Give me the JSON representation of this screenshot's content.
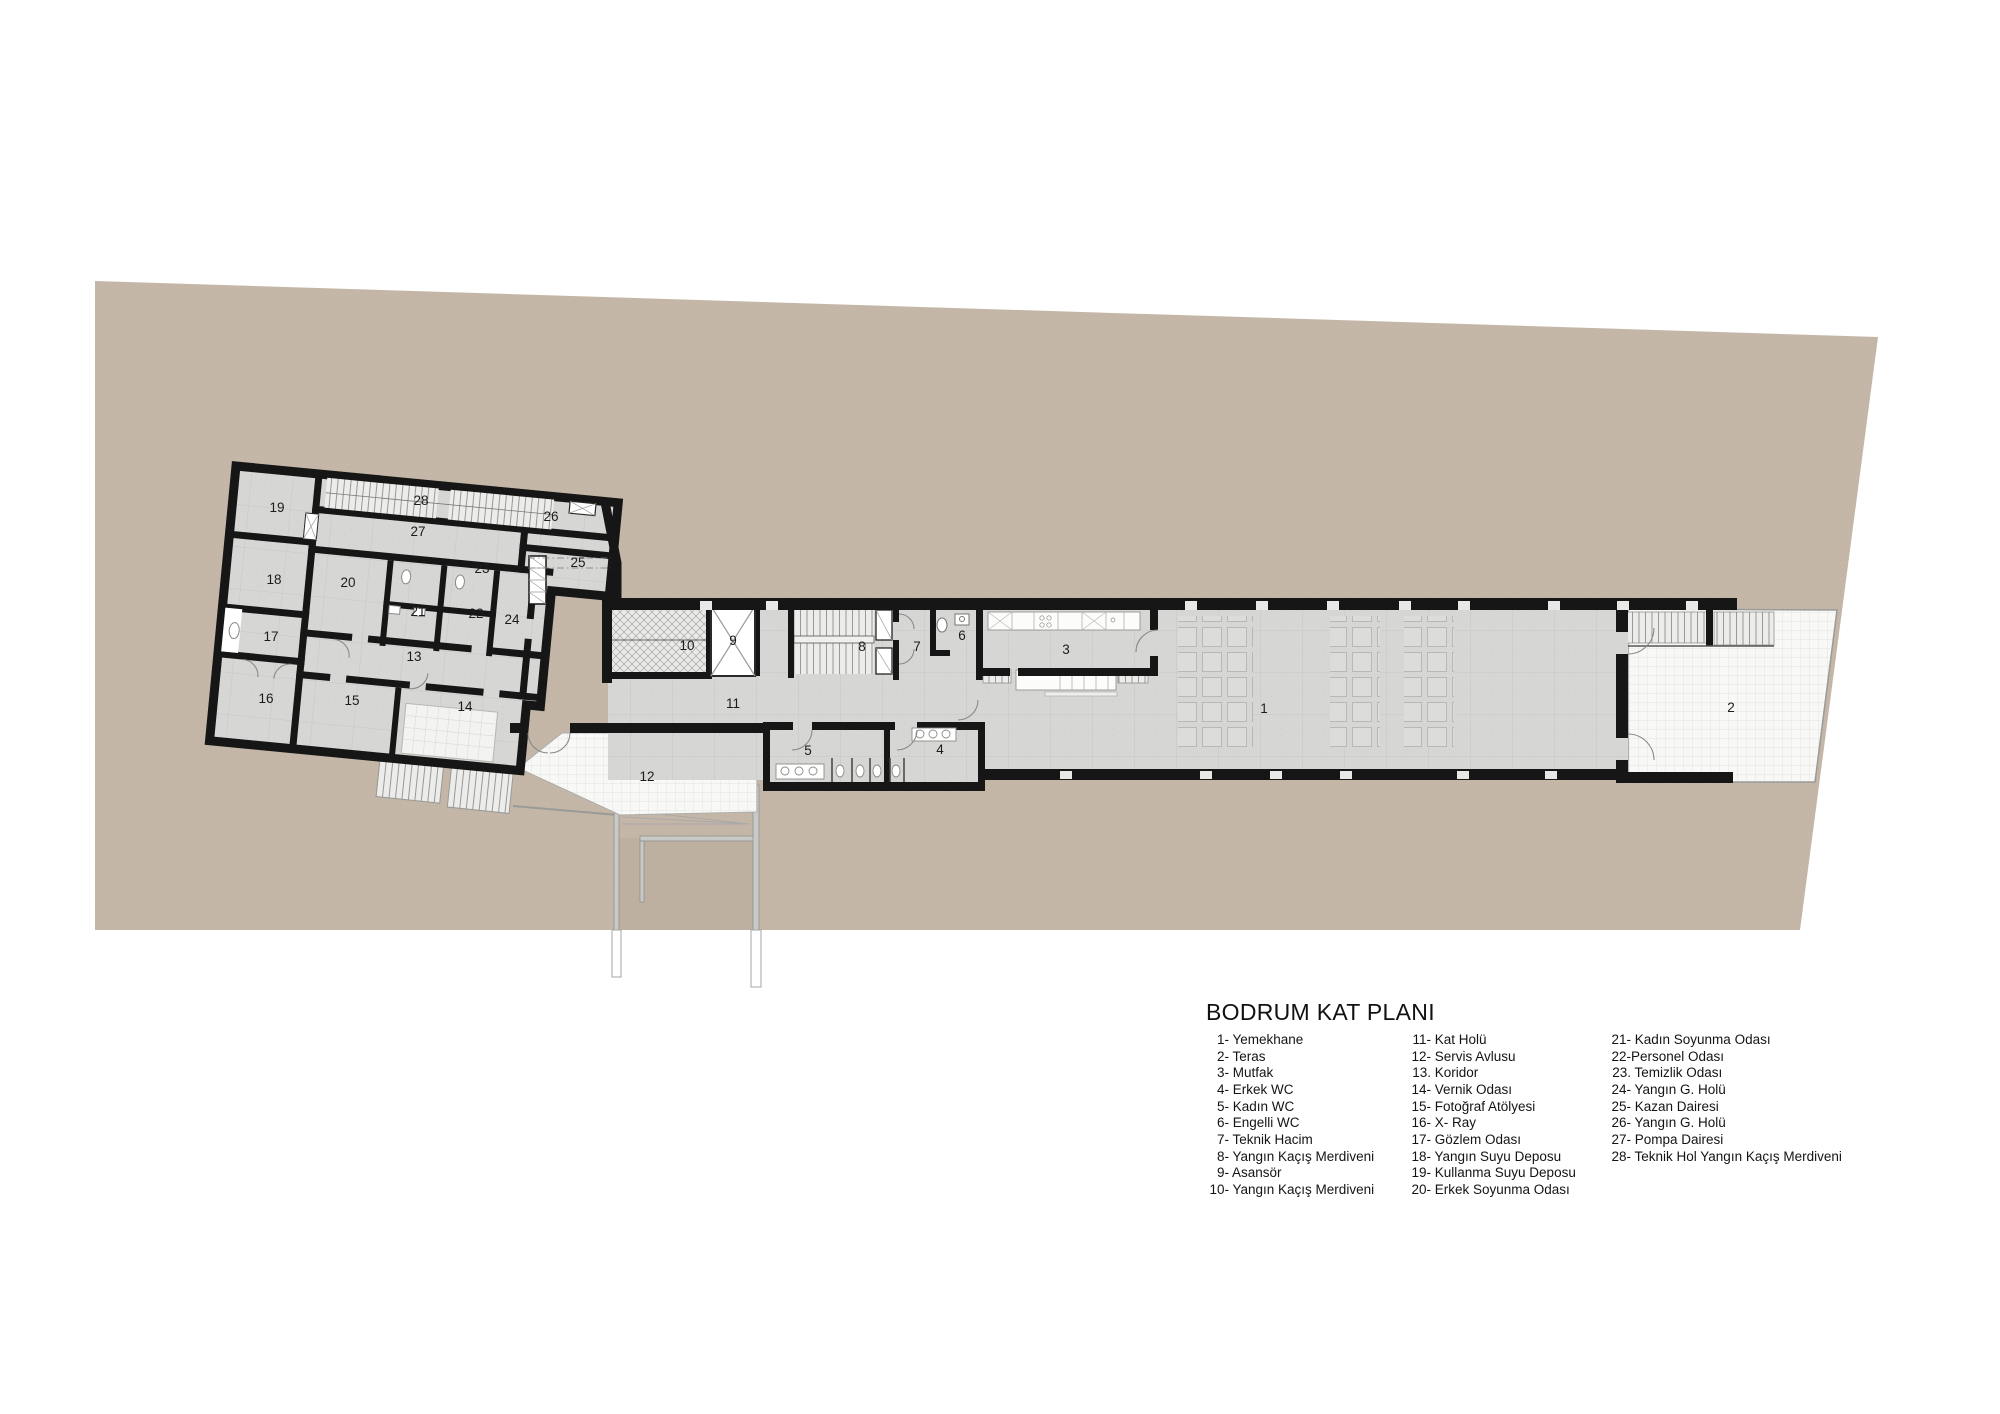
{
  "plan": {
    "title": "BODRUM KAT PLANI",
    "room_numbers": [
      "1",
      "2",
      "3",
      "4",
      "5",
      "6",
      "7",
      "8",
      "9",
      "10",
      "11",
      "12",
      "13",
      "14",
      "15",
      "16",
      "17",
      "18",
      "19",
      "20",
      "21",
      "22",
      "23",
      "24",
      "25",
      "26",
      "27",
      "28"
    ]
  },
  "legend": {
    "title": "BODRUM KAT PLANI",
    "columns": [
      {
        "items": [
          {
            "num": "1-",
            "name": " Yemekhane"
          },
          {
            "num": "2-",
            "name": " Teras"
          },
          {
            "num": "3-",
            "name": " Mutfak"
          },
          {
            "num": "4-",
            "name": " Erkek WC"
          },
          {
            "num": "5-",
            "name": " Kadın WC"
          },
          {
            "num": "6-",
            "name": " Engelli WC"
          },
          {
            "num": "7-",
            "name": " Teknik Hacim"
          },
          {
            "num": "8-",
            "name": " Yangın Kaçış Merdiveni"
          },
          {
            "num": "9-",
            "name": " Asansör"
          },
          {
            "num": "10-",
            "name": " Yangın Kaçış Merdiveni"
          }
        ]
      },
      {
        "items": [
          {
            "num": "11-",
            "name": " Kat Holü"
          },
          {
            "num": "12-",
            "name": " Servis Avlusu"
          },
          {
            "num": "13.",
            "name": " Koridor"
          },
          {
            "num": "14-",
            "name": " Vernik Odası"
          },
          {
            "num": "15-",
            "name": " Fotoğraf Atölyesi"
          },
          {
            "num": "16-",
            "name": " X- Ray"
          },
          {
            "num": "17-",
            "name": " Gözlem Odası"
          },
          {
            "num": "18-",
            "name": " Yangın Suyu Deposu"
          },
          {
            "num": "19-",
            "name": " Kullanma Suyu Deposu"
          },
          {
            "num": "20-",
            "name": " Erkek Soyunma Odası"
          }
        ]
      },
      {
        "items": [
          {
            "num": "21-",
            "name": " Kadın Soyunma Odası"
          },
          {
            "num": "22-",
            "name": "Personel Odası"
          },
          {
            "num": "23.",
            "name": " Temizlik Odası"
          },
          {
            "num": "24-",
            "name": " Yangın G. Holü"
          },
          {
            "num": "25-",
            "name": " Kazan Dairesi"
          },
          {
            "num": "26-",
            "name": " Yangın G. Holü"
          },
          {
            "num": "27-",
            "name": " Pompa Dairesi"
          },
          {
            "num": "28-",
            "name": " Teknik Hol Yangın Kaçış Merdiveni"
          }
        ]
      }
    ]
  },
  "colors": {
    "site_fill": "#c5b7a8",
    "site_dot": "#b4a695",
    "wall": "#161616",
    "floor_fill": "#d6d6d4",
    "paving_fill": "#f8f8f6",
    "page_bg": "#ffffff"
  }
}
